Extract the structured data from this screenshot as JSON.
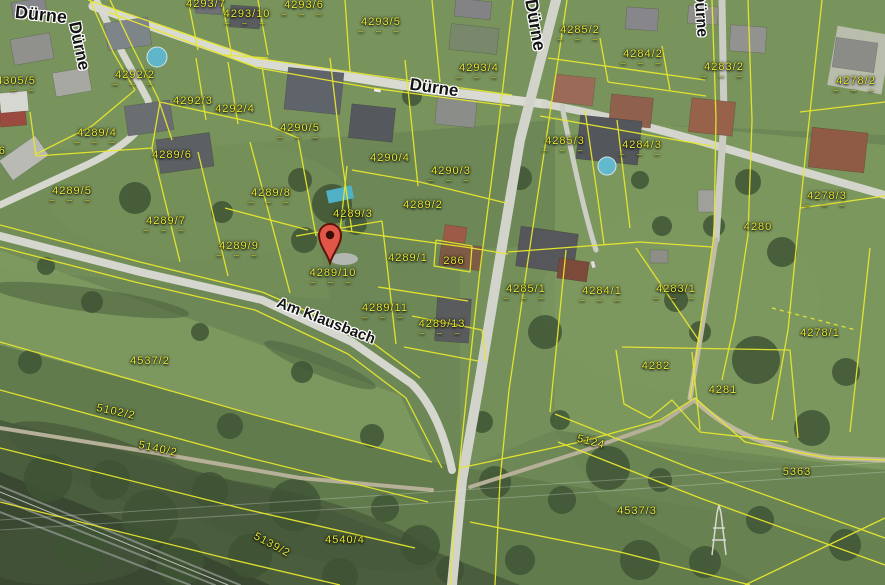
{
  "map": {
    "description": "Aerial cadastral map view",
    "colors": {
      "boundary_line": "#e7e72e",
      "parcel_text": "#e9ea36",
      "street_text": "#141414",
      "street_halo": "#ffffff",
      "marker_fill": "#e05648",
      "marker_border": "#611209",
      "road": "#d6d7cf",
      "field_green": "#6d8756"
    },
    "marker": {
      "parcel": "4289/10",
      "x": 330,
      "y": 263
    },
    "street_labels": [
      {
        "text": "Dürne",
        "x": 41,
        "y": 15,
        "rot": 6,
        "size": 18
      },
      {
        "text": "Dürne",
        "x": 79,
        "y": 46,
        "rot": 78,
        "size": 17
      },
      {
        "text": "Dürne",
        "x": 434,
        "y": 88,
        "rot": 8,
        "size": 17
      },
      {
        "text": "Dürne",
        "x": 535,
        "y": 25,
        "rot": 80,
        "size": 18
      },
      {
        "text": "Dürne",
        "x": 700,
        "y": 14,
        "rot": 86,
        "size": 16
      },
      {
        "text": "Am Klausbach",
        "x": 326,
        "y": 321,
        "rot": 21,
        "size": 15
      }
    ],
    "parcel_labels": [
      {
        "text": "4293/7",
        "x": 206,
        "y": 4,
        "dashes": false
      },
      {
        "text": "4293/10",
        "x": 247,
        "y": 17,
        "dashes": true
      },
      {
        "text": "4293/6",
        "x": 304,
        "y": 8,
        "dashes": true
      },
      {
        "text": "4293/5",
        "x": 381,
        "y": 25,
        "dashes": true
      },
      {
        "text": "4293/4",
        "x": 479,
        "y": 71,
        "dashes": true
      },
      {
        "text": "4285/2",
        "x": 580,
        "y": 33,
        "dashes": true
      },
      {
        "text": "4284/2",
        "x": 643,
        "y": 57,
        "dashes": true
      },
      {
        "text": "4283/2",
        "x": 724,
        "y": 70,
        "dashes": true
      },
      {
        "text": "4278/2",
        "x": 856,
        "y": 84,
        "dashes": true
      },
      {
        "text": "4305/5",
        "x": 16,
        "y": 84,
        "dashes": true
      },
      {
        "text": "4305/6",
        "x": -14,
        "y": 151,
        "dashes": false
      },
      {
        "text": "4292/2",
        "x": 135,
        "y": 78,
        "dashes": true
      },
      {
        "text": "4292/3",
        "x": 193,
        "y": 101,
        "dashes": false
      },
      {
        "text": "4292/4",
        "x": 235,
        "y": 109,
        "dashes": false
      },
      {
        "text": "4289/4",
        "x": 97,
        "y": 136,
        "dashes": true
      },
      {
        "text": "4289/6",
        "x": 172,
        "y": 155,
        "dashes": false
      },
      {
        "text": "4289/8",
        "x": 271,
        "y": 196,
        "dashes": true
      },
      {
        "text": "4289/5",
        "x": 72,
        "y": 194,
        "dashes": true
      },
      {
        "text": "4289/7",
        "x": 166,
        "y": 224,
        "dashes": true
      },
      {
        "text": "4289/9",
        "x": 239,
        "y": 249,
        "dashes": true
      },
      {
        "text": "4290/5",
        "x": 300,
        "y": 131,
        "dashes": true
      },
      {
        "text": "4290/4",
        "x": 390,
        "y": 158,
        "dashes": false
      },
      {
        "text": "4290/3",
        "x": 451,
        "y": 174,
        "dashes": true
      },
      {
        "text": "4289/2",
        "x": 423,
        "y": 205,
        "dashes": false
      },
      {
        "text": "4289/3",
        "x": 353,
        "y": 214,
        "dashes": false
      },
      {
        "text": "4289/1",
        "x": 408,
        "y": 258,
        "dashes": false
      },
      {
        "text": "286",
        "x": 454,
        "y": 261,
        "dashes": false
      },
      {
        "text": "4289/10",
        "x": 333,
        "y": 276,
        "dashes": true
      },
      {
        "text": "4289/11",
        "x": 385,
        "y": 311,
        "dashes": true
      },
      {
        "text": "4289/13",
        "x": 442,
        "y": 327,
        "dashes": true
      },
      {
        "text": "4285/3",
        "x": 565,
        "y": 144,
        "dashes": true
      },
      {
        "text": "4284/3",
        "x": 642,
        "y": 148,
        "dashes": true
      },
      {
        "text": "4285/1",
        "x": 526,
        "y": 292,
        "dashes": true
      },
      {
        "text": "4284/1",
        "x": 602,
        "y": 294,
        "dashes": true
      },
      {
        "text": "4283/1",
        "x": 676,
        "y": 292,
        "dashes": true
      },
      {
        "text": "4280",
        "x": 758,
        "y": 227,
        "dashes": false
      },
      {
        "text": "4278/3",
        "x": 827,
        "y": 199,
        "dashes": true
      },
      {
        "text": "4278/1",
        "x": 820,
        "y": 333,
        "dashes": false
      },
      {
        "text": "4282",
        "x": 656,
        "y": 366,
        "dashes": false
      },
      {
        "text": "4281",
        "x": 723,
        "y": 390,
        "dashes": false
      },
      {
        "text": "4537/2",
        "x": 150,
        "y": 361,
        "dashes": false
      },
      {
        "text": "5102/2",
        "x": 116,
        "y": 412,
        "rot": 12,
        "dashes": false
      },
      {
        "text": "5140/2",
        "x": 158,
        "y": 449,
        "rot": 12,
        "dashes": false
      },
      {
        "text": "5139/2",
        "x": 272,
        "y": 545,
        "rot": 28,
        "dashes": false
      },
      {
        "text": "4540/4",
        "x": 345,
        "y": 540,
        "dashes": false
      },
      {
        "text": "5124",
        "x": 591,
        "y": 442,
        "rot": 14,
        "dashes": false
      },
      {
        "text": "5363",
        "x": 797,
        "y": 472,
        "dashes": false
      },
      {
        "text": "4537/3",
        "x": 637,
        "y": 511,
        "dashes": false
      }
    ]
  }
}
